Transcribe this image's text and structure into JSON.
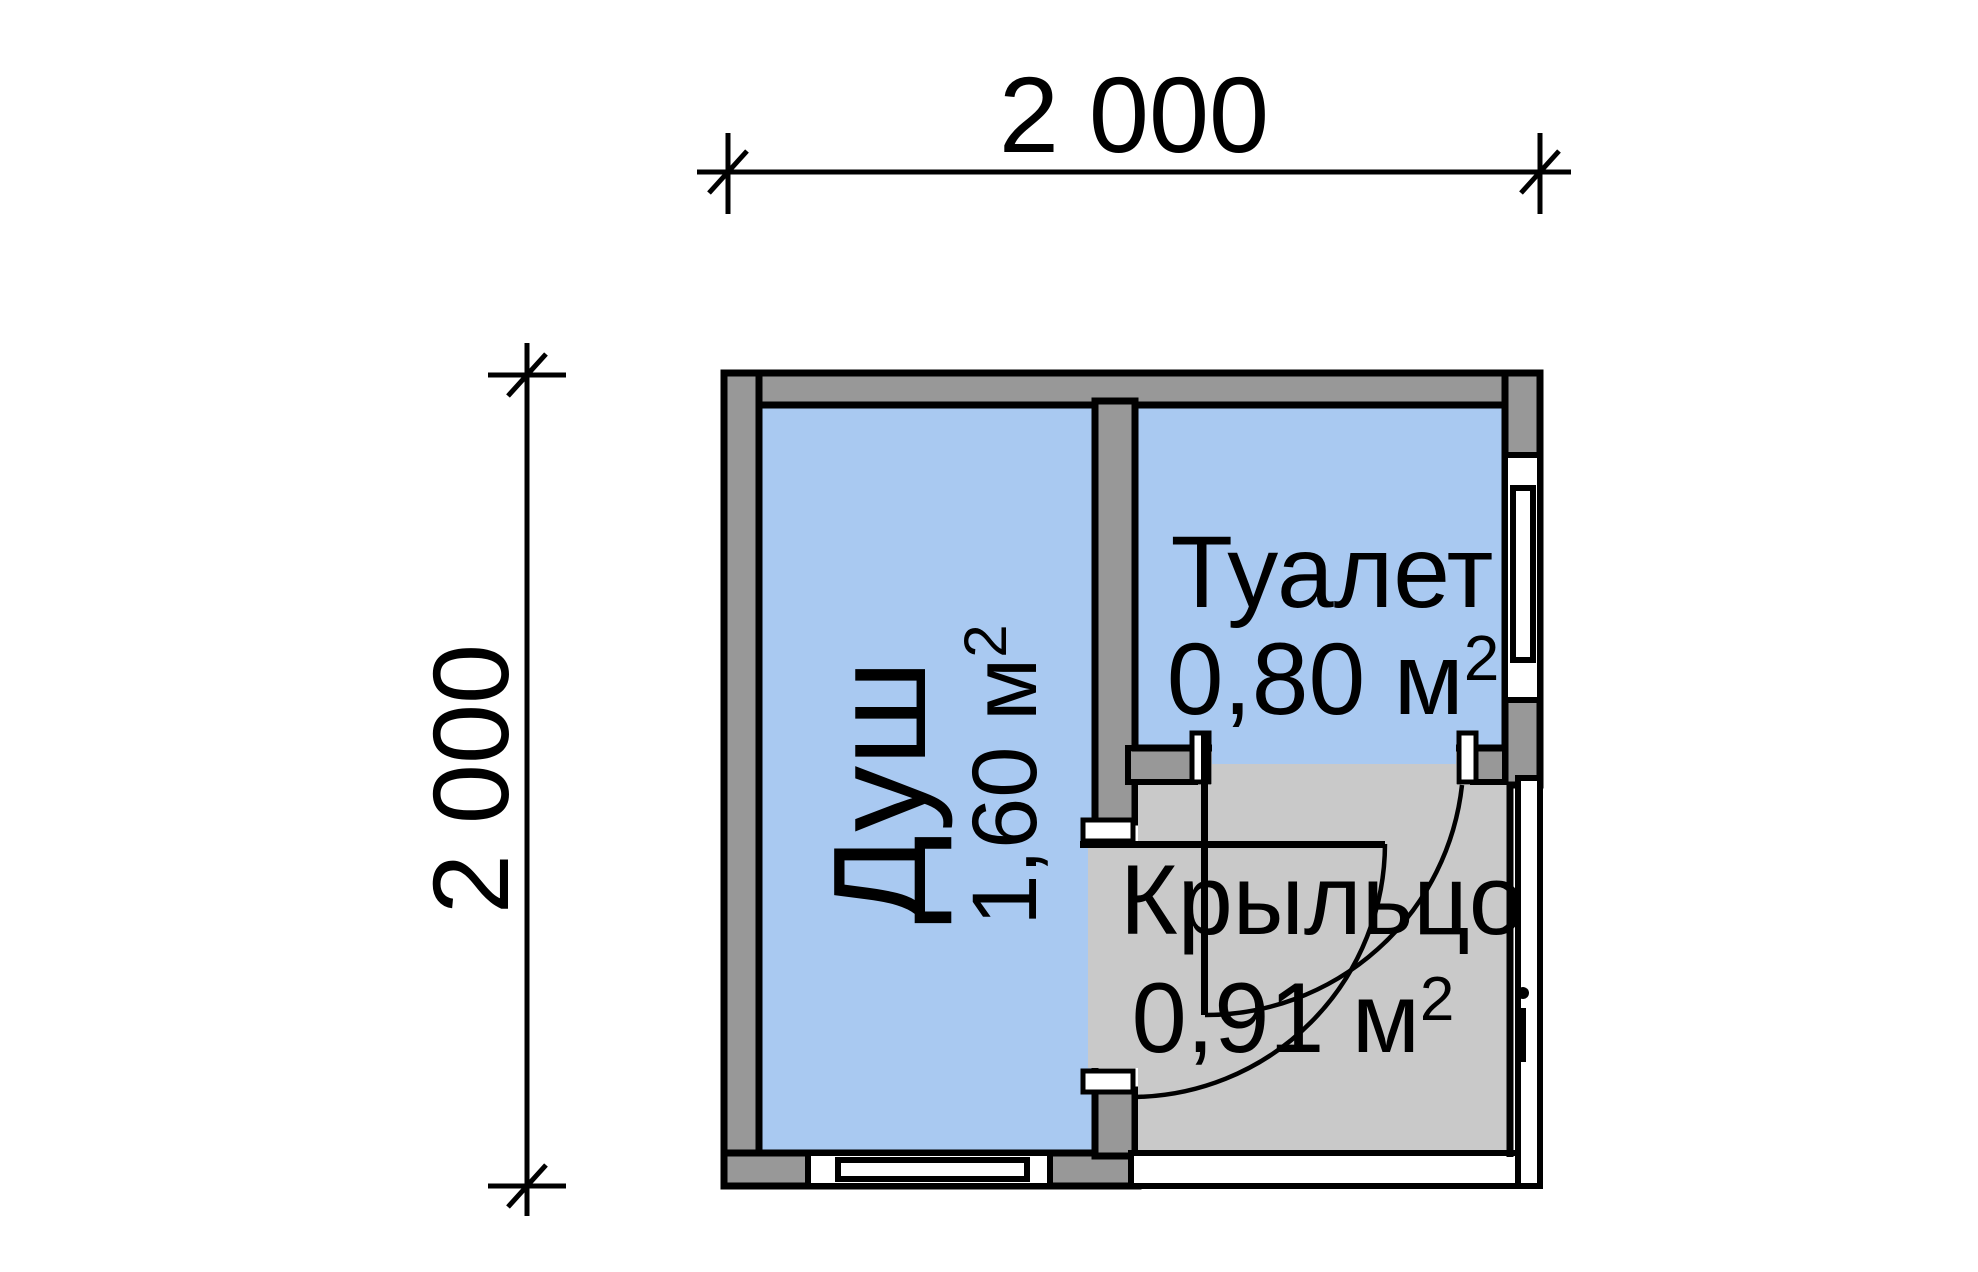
{
  "plan": {
    "dimension_top": "2 000",
    "dimension_left": "2 000",
    "rooms": [
      {
        "id": "shower",
        "label": "Душ",
        "area_value": "1,60 м",
        "area_sup": "2"
      },
      {
        "id": "toilet",
        "label": "Туалет",
        "area_value": "0,80 м",
        "area_sup": "2"
      },
      {
        "id": "porch",
        "label": "Крыльцо",
        "area_value": "0,91 м",
        "area_sup": "2"
      }
    ]
  },
  "colors": {
    "room-fill": "#a9c9f1",
    "wall-fill": "#989898",
    "porch-fill": "#c9c9c9",
    "line-color": "#000000",
    "background": "#ffffff"
  }
}
